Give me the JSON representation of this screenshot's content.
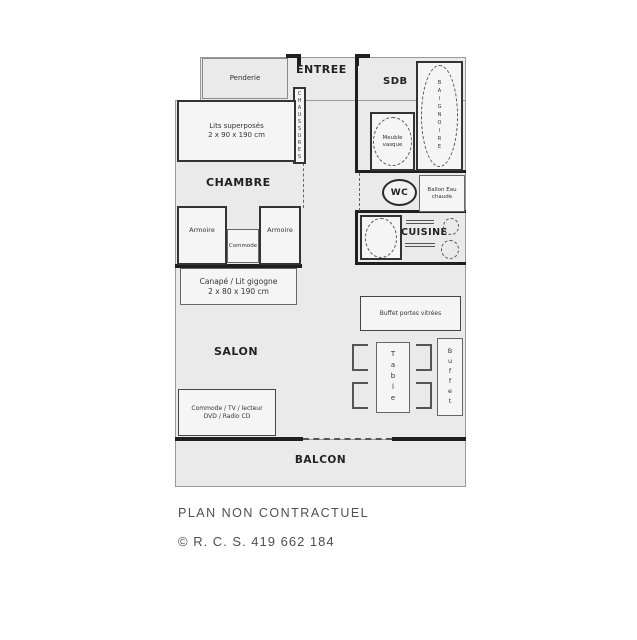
{
  "rooms": {
    "entree": "ENTREE",
    "sdb": "SDB",
    "chambre": "CHAMBRE",
    "salon": "SALON",
    "cuisine": "CUISINE",
    "balcon": "BALCON"
  },
  "furniture": {
    "penderie": "Penderie",
    "chaussures": "CHAUSSURES",
    "bunk_line1": "Lits superposés",
    "bunk_line2": "2 x 90 x 190 cm",
    "armoire_left": "Armoire",
    "commode": "Commode",
    "armoire_right": "Armoire",
    "sofa_line1": "Canapé / Lit gigogne",
    "sofa_line2": "2 x 80 x 190 cm",
    "tv_line1": "Commode / TV / lecteur",
    "tv_line2": "DVD / Radio CD",
    "baignoire": "BAIGNOIRE",
    "vasque_line1": "Meuble",
    "vasque_line2": "vasque",
    "wc": "WC",
    "ballon_line1": "Ballon Eau",
    "ballon_line2": "chaude",
    "buffet_wall": "Buffet portes vitrées",
    "table": "Table",
    "buffet_side": "Buffet"
  },
  "footer": {
    "disclaimer": "PLAN NON CONTRACTUEL",
    "registration": "© R. C. S. 419 662 184"
  }
}
